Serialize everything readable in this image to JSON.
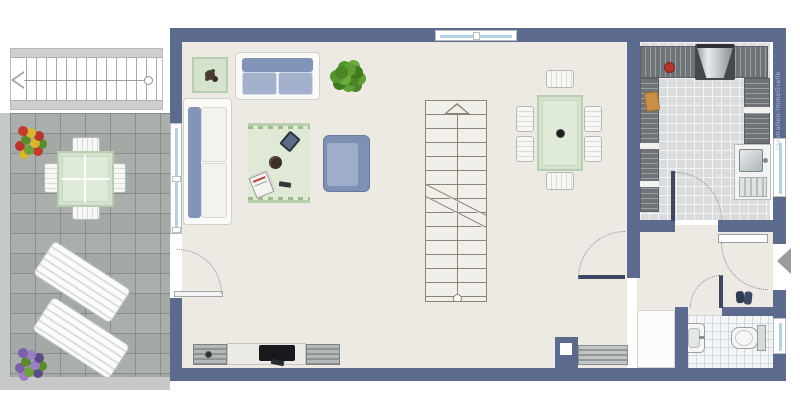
{
  "watermark": {
    "text": "Illustration:ImmoGrafik"
  },
  "colors": {
    "wall": "#5c6b8d",
    "floor": "#edeae4",
    "terrace_tile": "#a4a9a6",
    "terrace_edge": "#c6c9c7",
    "kitchen_floor": "#d9dbdc",
    "bath_floor": "#f3f5f6",
    "sofa_back": "#8294b8",
    "sofa_seat": "#a3b1cc",
    "armchair": "#7e91b5",
    "armchair_seat": "#9dadca",
    "rug": "#dfe9d6",
    "glass_green": "#d5e2cd",
    "plant_green": "#569630",
    "counter_gray": "#6e7377",
    "tv_black": "#17191c",
    "stair_line": "#8a8378",
    "arc": "#8a8a8a",
    "arrow_gray": "#9b9b9b",
    "window_glass": "#b5d3e2",
    "furn_white": "#fafaf8"
  },
  "rooms": [
    {
      "name": "terrace"
    },
    {
      "name": "living-dining-room"
    },
    {
      "name": "kitchen"
    },
    {
      "name": "hallway"
    },
    {
      "name": "bathroom"
    },
    {
      "name": "staircase"
    }
  ],
  "furniture": {
    "terrace": [
      "exterior-stairs",
      "flower-bush-red",
      "flower-bush-purple",
      "garden-table",
      "garden-chairs-x4",
      "sun-lounger-x2"
    ],
    "living": [
      "side-table-with-plant",
      "two-seat-sofa",
      "green-plant",
      "three-seat-sofa",
      "rug-with-tablet-bowl-magazines",
      "cube-armchair",
      "tv-lowboard",
      "chimney-block",
      "radiator",
      "interior-staircase",
      "dining-table",
      "dining-chairs-x6"
    ],
    "kitchen": [
      "worktop-u-shape",
      "cooker-with-hood",
      "kettle",
      "cutting-board",
      "sink-with-drainer"
    ],
    "hallway": [
      "shoes",
      "built-in-closet"
    ],
    "bathroom": [
      "wash-basin",
      "toilet"
    ]
  }
}
